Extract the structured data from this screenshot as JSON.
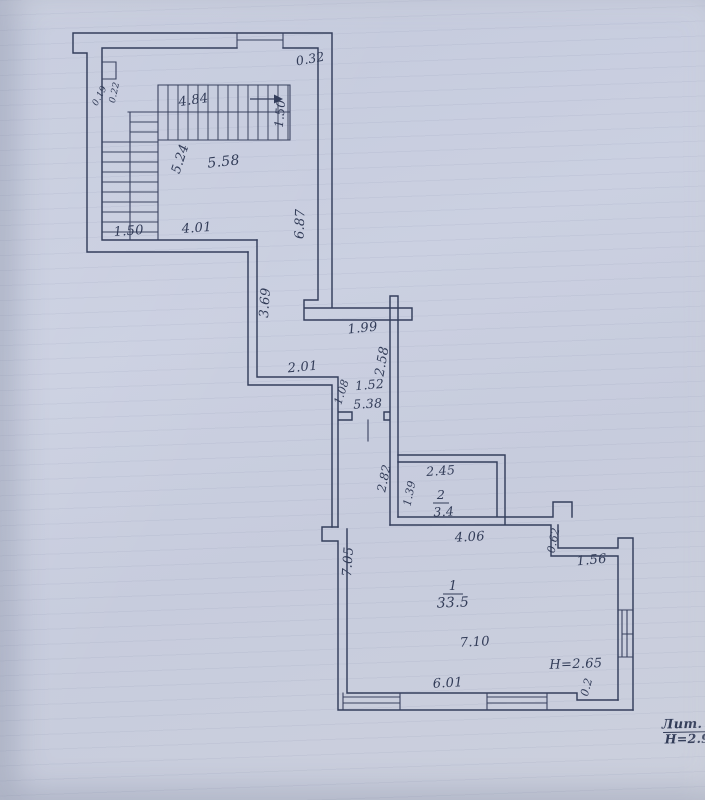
{
  "document": {
    "kind": "scanned floor plan (BTI technical drawing)",
    "litera": "Лит. А",
    "building_height": "Н=2.96"
  },
  "colors": {
    "paper": "#c9cede",
    "ink": "#333c5b"
  },
  "plan": {
    "rooms": [
      {
        "number": "1",
        "area": "33.5",
        "ceiling_height": "H=2.65"
      },
      {
        "number": "2",
        "area": "3.4"
      }
    ],
    "stairwell_dimensions": [
      "0.19",
      "0.22",
      "4.84",
      "1.50",
      "5.24",
      "5.58",
      "1.50",
      "4.01"
    ],
    "corridor_dimensions": [
      "0.32",
      "6.87",
      "3.69",
      "1.99",
      "2.58",
      "2.01",
      "1.08",
      "1.52",
      "5.38"
    ],
    "room_dimensions": [
      "2.82",
      "1.39",
      "2.45",
      "4.06",
      "0.62",
      "1.56",
      "7.05",
      "7.10",
      "6.01",
      "0.2"
    ]
  },
  "labels": [
    {
      "name": "dim-0-32",
      "text": "0.32",
      "x": 311,
      "y": 63,
      "rot": -10,
      "fs": 12.5
    },
    {
      "name": "dim-0-19",
      "text": "0.19",
      "x": 102,
      "y": 97,
      "rot": -62,
      "fs": 9
    },
    {
      "name": "dim-0-22",
      "text": "0.22",
      "x": 117,
      "y": 93,
      "rot": -78,
      "fs": 9
    },
    {
      "name": "dim-4-84",
      "text": "4.84",
      "x": 194,
      "y": 104,
      "rot": -8,
      "fs": 13
    },
    {
      "name": "dim-1-50-stair",
      "text": "1.50",
      "x": 284,
      "y": 114,
      "rot": -85,
      "fs": 12
    },
    {
      "name": "dim-5-24",
      "text": "5.24",
      "x": 184,
      "y": 160,
      "rot": -72,
      "fs": 13
    },
    {
      "name": "dim-5-58",
      "text": "5.58",
      "x": 224,
      "y": 166,
      "rot": -6,
      "fs": 14
    },
    {
      "name": "dim-6-87",
      "text": "6.87",
      "x": 304,
      "y": 224,
      "rot": -88,
      "fs": 13
    },
    {
      "name": "dim-1-50",
      "text": "1.50",
      "x": 129,
      "y": 235,
      "rot": -4,
      "fs": 13
    },
    {
      "name": "dim-4-01",
      "text": "4.01",
      "x": 197,
      "y": 232,
      "rot": -4,
      "fs": 13
    },
    {
      "name": "dim-3-69",
      "text": "3.69",
      "x": 269,
      "y": 303,
      "rot": -86,
      "fs": 13
    },
    {
      "name": "dim-1-99",
      "text": "1.99",
      "x": 363,
      "y": 332,
      "rot": -6,
      "fs": 13
    },
    {
      "name": "dim-2-58",
      "text": "2.58",
      "x": 386,
      "y": 362,
      "rot": -80,
      "fs": 13
    },
    {
      "name": "dim-2-01",
      "text": "2.01",
      "x": 303,
      "y": 371,
      "rot": -5,
      "fs": 13
    },
    {
      "name": "dim-1-08",
      "text": "1.08",
      "x": 345,
      "y": 393,
      "rot": -72,
      "fs": 11
    },
    {
      "name": "dim-1-52",
      "text": "1.52",
      "x": 370,
      "y": 389,
      "rot": -5,
      "fs": 12.5
    },
    {
      "name": "dim-5-38",
      "text": "5.38",
      "x": 368,
      "y": 408,
      "rot": -3,
      "fs": 12.5
    },
    {
      "name": "dim-2-82",
      "text": "2.82",
      "x": 388,
      "y": 479,
      "rot": -78,
      "fs": 12
    },
    {
      "name": "dim-1-39",
      "text": "1.39",
      "x": 413,
      "y": 494,
      "rot": -78,
      "fs": 11
    },
    {
      "name": "dim-2-45",
      "text": "2.45",
      "x": 441,
      "y": 475,
      "rot": -4,
      "fs": 12.5
    },
    {
      "name": "room2-number",
      "text": "2",
      "x": 441,
      "y": 499,
      "rot": 0,
      "fs": 12.5,
      "ul": 16
    },
    {
      "name": "room2-area",
      "text": "3.4",
      "x": 444,
      "y": 516,
      "rot": -3,
      "fs": 12.5
    },
    {
      "name": "dim-4-06",
      "text": "4.06",
      "x": 470,
      "y": 541,
      "rot": -3,
      "fs": 13
    },
    {
      "name": "dim-0-62",
      "text": "0.62",
      "x": 557,
      "y": 541,
      "rot": -78,
      "fs": 11
    },
    {
      "name": "dim-1-56",
      "text": "1.56",
      "x": 592,
      "y": 564,
      "rot": -5,
      "fs": 13
    },
    {
      "name": "dim-7-05",
      "text": "7.05",
      "x": 352,
      "y": 562,
      "rot": -86,
      "fs": 13
    },
    {
      "name": "room1-number",
      "text": "1",
      "x": 453,
      "y": 590,
      "rot": 0,
      "fs": 13,
      "ul": 20
    },
    {
      "name": "room1-area",
      "text": "33.5",
      "x": 453,
      "y": 607,
      "rot": -2,
      "fs": 14
    },
    {
      "name": "dim-7-10",
      "text": "7.10",
      "x": 475,
      "y": 646,
      "rot": -3,
      "fs": 13
    },
    {
      "name": "ceiling-height-room1",
      "text": "H=2.65",
      "x": 576,
      "y": 668,
      "rot": -2,
      "fs": 13
    },
    {
      "name": "dim-6-01",
      "text": "6.01",
      "x": 448,
      "y": 687,
      "rot": -3,
      "fs": 13
    },
    {
      "name": "dim-0-2",
      "text": "0.2",
      "x": 590,
      "y": 688,
      "rot": -75,
      "fs": 11
    },
    {
      "name": "litera-label",
      "text": "Лит. А",
      "x": 690,
      "y": 728,
      "rot": -1,
      "fs": 13,
      "ul": 54,
      "bold": true
    },
    {
      "name": "litera-height",
      "text": "Н=2.96",
      "x": 692,
      "y": 743,
      "rot": -1,
      "fs": 12.5,
      "bold": true
    }
  ]
}
